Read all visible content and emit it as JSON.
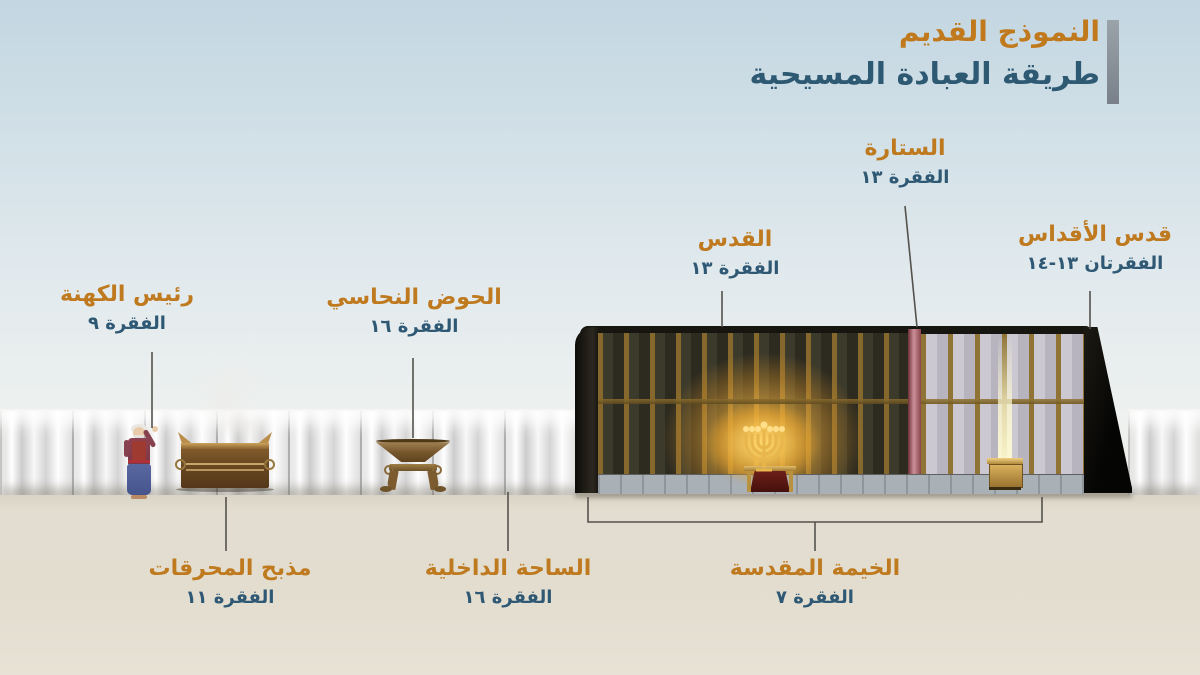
{
  "title": {
    "line1": "النموذج القديم",
    "line2": "طريقة العبادة المسيحية"
  },
  "labels": {
    "curtain": {
      "name": "الستارة",
      "ref": "الفقرة ١٣"
    },
    "holy_place": {
      "name": "القدس",
      "ref": "الفقرة ١٣"
    },
    "holy_of_holies": {
      "name": "قدس الأقداس",
      "ref": "الفقرتان ١٣-١٤"
    },
    "high_priest": {
      "name": "رئيس الكهنة",
      "ref": "الفقرة ٩"
    },
    "bronze_basin": {
      "name": "الحوض النحاسي",
      "ref": "الفقرة ١٦"
    },
    "burnt_offering_altar": {
      "name": "مذبح المحرقات",
      "ref": "الفقرة ١١"
    },
    "inner_court": {
      "name": "الساحة الداخلية",
      "ref": "الفقرة ١٦"
    },
    "sacred_tent": {
      "name": "الخيمة المقدسة",
      "ref": "الفقرة ٧"
    }
  },
  "colors": {
    "label_title_orange": "#bf7a1f",
    "label_ref_blue": "#2e5873",
    "headline_orange": "#c07a1d",
    "headline_blue": "#2e5973",
    "title_bar_gray": "#868e96",
    "pointer_gray": "#54524c",
    "ground_beige": "#e2ddcf",
    "sky_blue": "#c3d6e1"
  }
}
